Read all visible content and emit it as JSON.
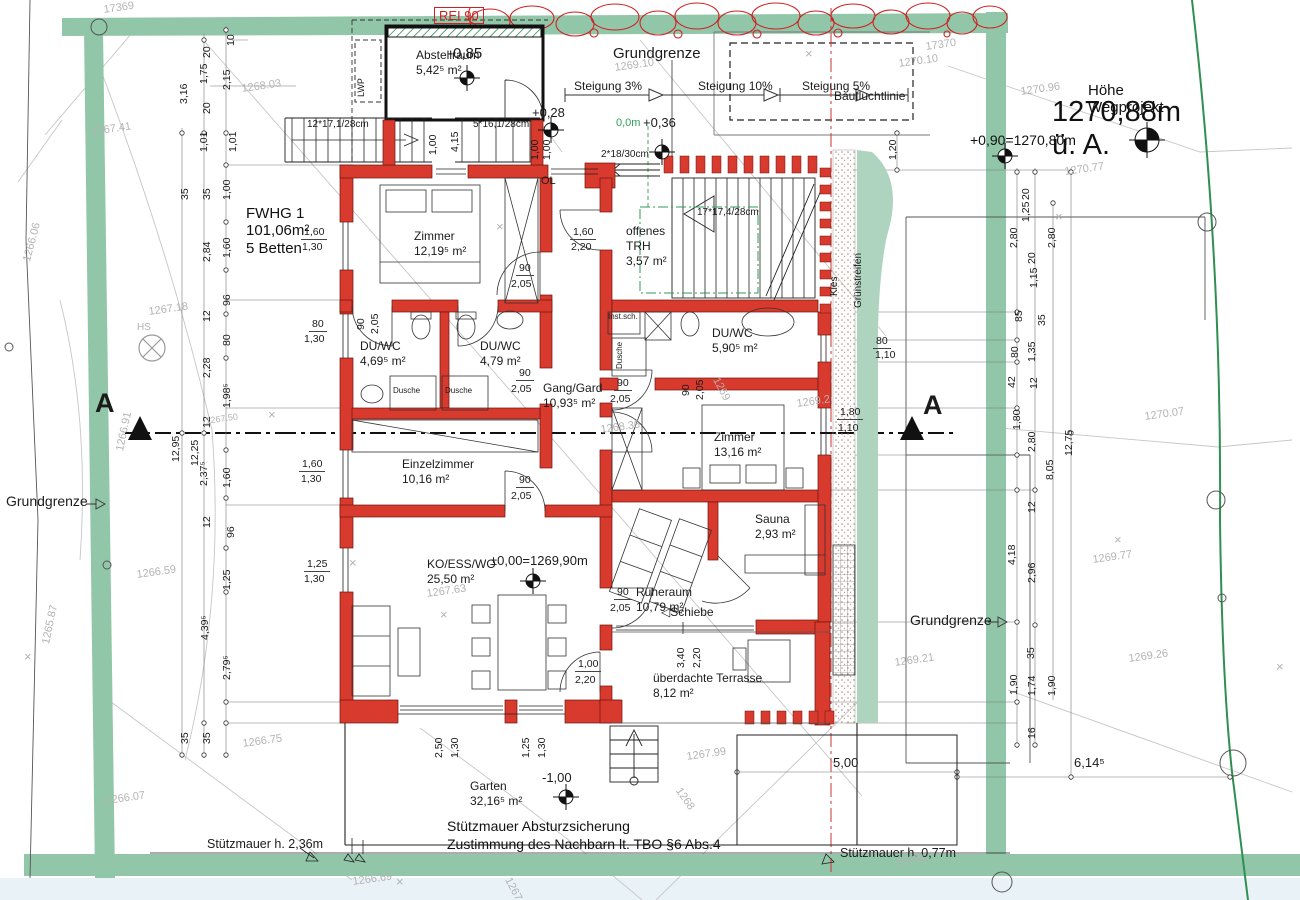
{
  "title": {
    "hoehe_label": "Höhe Wegprojekt",
    "hoehe_value": "1270,88m ü. A.",
    "weg_level": "+0,90=1270,80m"
  },
  "apartment": {
    "name": "FWHG 1",
    "area": "101,06m²",
    "beds": "5 Betten"
  },
  "notes": {
    "note1": "Stützmauer Absturzsicherung",
    "note2": "Zustimmung des Nachbarn lt. TBO §6 Abs.4"
  },
  "colors": {
    "wall_red": "#d93a2e",
    "boundary_green": "#92c6a9",
    "green_strip": "#aed3bf",
    "accent_green": "#2e9e57",
    "terrain_gray": "#b3b3b3",
    "red_line": "#cc3333"
  },
  "rooms": [
    {
      "n": "room-abstellraum",
      "name": "Abstellraum",
      "area": "5,42⁵ m²",
      "x": 416,
      "y": 48
    },
    {
      "n": "room-zimmer-1",
      "name": "Zimmer",
      "area": "12,19⁵ m²",
      "x": 414,
      "y": 229
    },
    {
      "n": "room-duwc-1",
      "name": "DU/WC",
      "area": "4,69⁵ m²",
      "x": 360,
      "y": 339
    },
    {
      "n": "room-duwc-2",
      "name": "DU/WC",
      "area": "4,79 m²",
      "x": 480,
      "y": 339
    },
    {
      "n": "room-offenes-trh",
      "name": "offenes TRH",
      "area": "3,57 m²",
      "x": 626,
      "y": 224,
      "wrap": 1
    },
    {
      "n": "room-duwc-3",
      "name": "DU/WC",
      "area": "5,90⁵ m²",
      "x": 712,
      "y": 326
    },
    {
      "n": "room-gang-gard",
      "name": "Gang/Gard",
      "area": "10,93⁵ m²",
      "x": 543,
      "y": 381
    },
    {
      "n": "room-zimmer-2",
      "name": "Zimmer",
      "area": "13,16 m²",
      "x": 714,
      "y": 430
    },
    {
      "n": "room-einzelzimmer",
      "name": "Einzelzimmer",
      "area": "10,16 m²",
      "x": 402,
      "y": 457
    },
    {
      "n": "room-sauna",
      "name": "Sauna",
      "area": "2,93 m²",
      "x": 755,
      "y": 512
    },
    {
      "n": "room-ko-ess-wo",
      "name": "KO/ESS/WO",
      "area": "25,50 m²",
      "x": 427,
      "y": 557
    },
    {
      "n": "room-ruheraum",
      "name": "Ruheraum",
      "area": "10,79 m²",
      "x": 636,
      "y": 585
    },
    {
      "n": "room-terrasse",
      "name": "überdachte Terrasse",
      "area": "8,12 m²",
      "x": 653,
      "y": 671
    },
    {
      "n": "room-garten",
      "name": "Garten",
      "area": "32,16⁵ m²",
      "x": 470,
      "y": 779
    }
  ],
  "annotations": [
    {
      "t": "Grundgrenze",
      "x": 613,
      "y": 46,
      "s": 15
    },
    {
      "t": "Steigung 3%",
      "x": 574,
      "y": 80,
      "s": 12
    },
    {
      "t": "Steigung 10%",
      "x": 698,
      "y": 80,
      "s": 12
    },
    {
      "t": "Steigung 5%",
      "x": 802,
      "y": 80,
      "s": 12
    },
    {
      "t": "Baufluchtlinie",
      "x": 834,
      "y": 90,
      "s": 12
    },
    {
      "t": "Grundgrenze",
      "x": 6,
      "y": 494,
      "s": 14
    },
    {
      "t": "Grundgrenze",
      "x": 910,
      "y": 613,
      "s": 14
    },
    {
      "t": "A",
      "x": 95,
      "y": 390,
      "s": 27,
      "c": "b"
    },
    {
      "t": "A",
      "x": 923,
      "y": 392,
      "s": 27,
      "c": "b"
    },
    {
      "t": "REI 90",
      "x": 434,
      "y": 7,
      "s": 13,
      "c": "red box"
    },
    {
      "t": "-0,85",
      "x": 448,
      "y": 46,
      "s": 15
    },
    {
      "t": "+0,28",
      "x": 532,
      "y": 106,
      "s": 13
    },
    {
      "t": "+0,36",
      "x": 643,
      "y": 116,
      "s": 13
    },
    {
      "t": "0,0m",
      "x": 616,
      "y": 118,
      "s": 11,
      "c": "grn"
    },
    {
      "t": "±0,00=1269,90m",
      "x": 490,
      "y": 554,
      "s": 13
    },
    {
      "t": "-1,00",
      "x": 542,
      "y": 771,
      "s": 13
    },
    {
      "t": "12*17,1/28cm",
      "x": 307,
      "y": 120,
      "s": 10
    },
    {
      "t": "5*16,1/28cm",
      "x": 473,
      "y": 120,
      "s": 10
    },
    {
      "t": "2*18/30cm",
      "x": 601,
      "y": 150,
      "s": 10
    },
    {
      "t": "17*17,4/28cm",
      "x": 697,
      "y": 208,
      "s": 10
    },
    {
      "t": "OL",
      "x": 541,
      "y": 176,
      "s": 11
    },
    {
      "t": "LWP",
      "x": 357,
      "y": 97,
      "s": 9,
      "r": -90
    },
    {
      "t": "HS",
      "x": 137,
      "y": 323,
      "s": 10,
      "c": "g"
    },
    {
      "t": "Inst.sch.",
      "x": 608,
      "y": 313,
      "s": 8
    },
    {
      "t": "Dusche",
      "x": 393,
      "y": 387,
      "s": 8
    },
    {
      "t": "Dusche",
      "x": 445,
      "y": 387,
      "s": 8
    },
    {
      "t": "Dusche",
      "x": 616,
      "y": 369,
      "s": 8,
      "r": -90
    },
    {
      "t": "Kies",
      "x": 830,
      "y": 296,
      "s": 10,
      "r": -90
    },
    {
      "t": "Grünstreifen",
      "x": 854,
      "y": 308,
      "s": 10,
      "r": -90
    },
    {
      "t": "◁Schiebe",
      "x": 661,
      "y": 606,
      "s": 12
    },
    {
      "t": "Stützmauer h. 2,36m",
      "x": 207,
      "y": 838,
      "s": 12.5
    },
    {
      "t": "Stützmauer h. 0,77m",
      "x": 840,
      "y": 847,
      "s": 12.5
    }
  ],
  "dimensions": [
    {
      "t": "10",
      "x": 226,
      "y": 46,
      "r": -90
    },
    {
      "t": "20",
      "x": 202,
      "y": 58,
      "r": -90
    },
    {
      "t": "1,75",
      "x": 199,
      "y": 84,
      "r": -90
    },
    {
      "t": "2,15",
      "x": 222,
      "y": 90,
      "r": -90
    },
    {
      "t": "3,16",
      "x": 179,
      "y": 104,
      "r": -90
    },
    {
      "t": "20",
      "x": 202,
      "y": 114,
      "r": -90
    },
    {
      "t": "1,01",
      "x": 199,
      "y": 152,
      "r": -90
    },
    {
      "t": "1,01",
      "x": 228,
      "y": 152,
      "r": -90
    },
    {
      "t": "35",
      "x": 180,
      "y": 200,
      "r": -90
    },
    {
      "t": "35",
      "x": 202,
      "y": 200,
      "r": -90
    },
    {
      "t": "1,00",
      "x": 222,
      "y": 200,
      "r": -90
    },
    {
      "t": "2,84",
      "x": 202,
      "y": 262,
      "r": -90
    },
    {
      "t": "1,60",
      "x": 222,
      "y": 258,
      "r": -90
    },
    {
      "t": "96",
      "x": 222,
      "y": 306,
      "r": -90
    },
    {
      "t": "12",
      "x": 202,
      "y": 322,
      "r": -90
    },
    {
      "t": "80",
      "x": 222,
      "y": 346,
      "r": -90
    },
    {
      "t": "2,28",
      "x": 202,
      "y": 378,
      "r": -90
    },
    {
      "t": "1,98⁵",
      "x": 222,
      "y": 408,
      "r": -90
    },
    {
      "t": "12",
      "x": 202,
      "y": 428,
      "r": -90
    },
    {
      "t": "12,95",
      "x": 171,
      "y": 462,
      "r": -90
    },
    {
      "t": "12,25",
      "x": 190,
      "y": 466,
      "r": -90
    },
    {
      "t": "2,37⁵",
      "x": 199,
      "y": 486,
      "r": -90
    },
    {
      "t": "1,60",
      "x": 222,
      "y": 488,
      "r": -90
    },
    {
      "t": "12",
      "x": 202,
      "y": 528,
      "r": -90
    },
    {
      "t": "96",
      "x": 226,
      "y": 538,
      "r": -90
    },
    {
      "t": "1,25",
      "x": 222,
      "y": 590,
      "r": -90
    },
    {
      "t": "4,39⁵",
      "x": 200,
      "y": 640,
      "r": -90
    },
    {
      "t": "2,79⁵",
      "x": 222,
      "y": 680,
      "r": -90
    },
    {
      "t": "35",
      "x": 180,
      "y": 744,
      "r": -90
    },
    {
      "t": "35",
      "x": 202,
      "y": 744,
      "r": -90
    },
    {
      "t": "1,00",
      "x": 428,
      "y": 155,
      "r": -90
    },
    {
      "t": "4,15",
      "x": 450,
      "y": 152,
      "r": -90
    },
    {
      "t": "1,00",
      "x": 530,
      "y": 160,
      "r": -90
    },
    {
      "t": "1,00",
      "x": 542,
      "y": 160,
      "r": -90
    },
    {
      "t": "1,20",
      "x": 888,
      "y": 160,
      "r": -90
    },
    {
      "t": "90",
      "x": 356,
      "y": 330,
      "r": -90
    },
    {
      "t": "2,05",
      "x": 370,
      "y": 334,
      "r": -90
    },
    {
      "t": "90",
      "x": 681,
      "y": 396,
      "r": -90
    },
    {
      "t": "2,05",
      "x": 695,
      "y": 400,
      "r": -90
    },
    {
      "t": "2,50",
      "x": 434,
      "y": 758,
      "r": -90
    },
    {
      "t": "1,30",
      "x": 450,
      "y": 758,
      "r": -90
    },
    {
      "t": "1,25",
      "x": 521,
      "y": 758,
      "r": -90
    },
    {
      "t": "1,30",
      "x": 537,
      "y": 758,
      "r": -90
    },
    {
      "t": "3,40",
      "x": 676,
      "y": 668,
      "r": -90
    },
    {
      "t": "2,20",
      "x": 692,
      "y": 668,
      "r": -90
    },
    {
      "t": "20",
      "x": 1021,
      "y": 200,
      "r": -90
    },
    {
      "t": "1,25",
      "x": 1021,
      "y": 222,
      "r": -90
    },
    {
      "t": "2,80",
      "x": 1009,
      "y": 248,
      "r": -90
    },
    {
      "t": "2,80",
      "x": 1047,
      "y": 248,
      "r": -90
    },
    {
      "t": "20",
      "x": 1027,
      "y": 264,
      "r": -90
    },
    {
      "t": "1,15",
      "x": 1029,
      "y": 288,
      "r": -90
    },
    {
      "t": "85",
      "x": 1014,
      "y": 322,
      "r": -90
    },
    {
      "t": "35",
      "x": 1037,
      "y": 326,
      "r": -90
    },
    {
      "t": "80",
      "x": 1010,
      "y": 358,
      "r": -90
    },
    {
      "t": "1,35",
      "x": 1027,
      "y": 362,
      "r": -90
    },
    {
      "t": "42",
      "x": 1007,
      "y": 388,
      "r": -90
    },
    {
      "t": "12",
      "x": 1029,
      "y": 389,
      "r": -90
    },
    {
      "t": "1,80",
      "x": 1012,
      "y": 430,
      "r": -90
    },
    {
      "t": "2,80",
      "x": 1027,
      "y": 452,
      "r": -90
    },
    {
      "t": "8,05",
      "x": 1045,
      "y": 480,
      "r": -90
    },
    {
      "t": "12,75",
      "x": 1064,
      "y": 456,
      "r": -90
    },
    {
      "t": "12",
      "x": 1027,
      "y": 513,
      "r": -90
    },
    {
      "t": "4,18",
      "x": 1007,
      "y": 565,
      "r": -90
    },
    {
      "t": "2,96",
      "x": 1027,
      "y": 583,
      "r": -90
    },
    {
      "t": "35",
      "x": 1026,
      "y": 659,
      "r": -90
    },
    {
      "t": "1,90",
      "x": 1009,
      "y": 695,
      "r": -90
    },
    {
      "t": "1,74",
      "x": 1027,
      "y": 696,
      "r": -90
    },
    {
      "t": "1,90",
      "x": 1047,
      "y": 696,
      "r": -90
    },
    {
      "t": "16",
      "x": 1027,
      "y": 739,
      "r": -90
    },
    {
      "t": "1,60",
      "x": 301,
      "y": 227,
      "u": 1
    },
    {
      "t": "1,30",
      "x": 302,
      "y": 242
    },
    {
      "t": "80",
      "x": 309,
      "y": 319,
      "u": 1
    },
    {
      "t": "1,30",
      "x": 304,
      "y": 334
    },
    {
      "t": "1,60",
      "x": 299,
      "y": 459,
      "u": 1
    },
    {
      "t": "1,30",
      "x": 301,
      "y": 474
    },
    {
      "t": "1,25",
      "x": 304,
      "y": 559,
      "u": 1
    },
    {
      "t": "1,30",
      "x": 304,
      "y": 574
    },
    {
      "t": "90",
      "x": 516,
      "y": 263,
      "u": 1
    },
    {
      "t": "2,05",
      "x": 511,
      "y": 279
    },
    {
      "t": "90",
      "x": 516,
      "y": 368,
      "u": 1
    },
    {
      "t": "2,05",
      "x": 511,
      "y": 384
    },
    {
      "t": "90",
      "x": 614,
      "y": 378,
      "u": 1
    },
    {
      "t": "2,05",
      "x": 610,
      "y": 394
    },
    {
      "t": "90",
      "x": 516,
      "y": 475,
      "u": 1
    },
    {
      "t": "2,05",
      "x": 511,
      "y": 491
    },
    {
      "t": "90",
      "x": 614,
      "y": 587,
      "u": 1
    },
    {
      "t": "2,05",
      "x": 610,
      "y": 603
    },
    {
      "t": "1,60",
      "x": 570,
      "y": 227,
      "u": 1
    },
    {
      "t": "2,20",
      "x": 571,
      "y": 242
    },
    {
      "t": "1,00",
      "x": 575,
      "y": 659,
      "u": 1
    },
    {
      "t": "2,20",
      "x": 575,
      "y": 675
    },
    {
      "t": "80",
      "x": 873,
      "y": 336,
      "u": 1
    },
    {
      "t": "1,10",
      "x": 875,
      "y": 350
    },
    {
      "t": "1,80",
      "x": 837,
      "y": 407,
      "u": 1
    },
    {
      "t": "1,10",
      "x": 838,
      "y": 423
    },
    {
      "t": "5,00",
      "x": 833,
      "y": 756,
      "s": 13
    },
    {
      "t": "6,14⁵",
      "x": 1074,
      "y": 756,
      "s": 13
    }
  ],
  "terrain": [
    {
      "t": "17369",
      "x": 103,
      "y": 5
    },
    {
      "t": "1268.03",
      "x": 241,
      "y": 84
    },
    {
      "t": "1267.41",
      "x": 91,
      "y": 127
    },
    {
      "t": "1266.06",
      "x": 22,
      "y": 260,
      "r": -75
    },
    {
      "t": "1269.10",
      "x": 614,
      "y": 63
    },
    {
      "t": "1270.10",
      "x": 898,
      "y": 59
    },
    {
      "t": "17370",
      "x": 925,
      "y": 42
    },
    {
      "t": "1270.96",
      "x": 1020,
      "y": 87
    },
    {
      "t": "1270.77",
      "x": 1064,
      "y": 167
    },
    {
      "t": "1270.07",
      "x": 1144,
      "y": 412
    },
    {
      "t": "1267.18",
      "x": 148,
      "y": 307
    },
    {
      "t": "1267.50",
      "x": 205,
      "y": 417,
      "s": 9
    },
    {
      "t": "1266.91",
      "x": 115,
      "y": 450,
      "r": -78
    },
    {
      "t": "1265.87",
      "x": 41,
      "y": 643,
      "r": -78
    },
    {
      "t": "1266.59",
      "x": 136,
      "y": 570
    },
    {
      "t": "1266.75",
      "x": 242,
      "y": 739
    },
    {
      "t": "1266.07",
      "x": 105,
      "y": 796
    },
    {
      "t": "1266.69",
      "x": 352,
      "y": 877
    },
    {
      "t": "1267.63",
      "x": 426,
      "y": 589
    },
    {
      "t": "1268.36",
      "x": 600,
      "y": 425
    },
    {
      "t": "1269.2",
      "x": 796,
      "y": 399
    },
    {
      "t": "1269.21",
      "x": 894,
      "y": 658
    },
    {
      "t": "1267.99",
      "x": 686,
      "y": 752
    },
    {
      "t": "1269.26",
      "x": 1128,
      "y": 654
    },
    {
      "t": "1269.77",
      "x": 1092,
      "y": 555
    },
    {
      "t": "15795",
      "x": 896,
      "y": 858
    },
    {
      "t": "1268",
      "x": 682,
      "y": 786,
      "r": 55
    },
    {
      "t": "1267",
      "x": 512,
      "y": 876,
      "r": 62
    },
    {
      "t": "1269",
      "x": 720,
      "y": 376,
      "r": 62
    },
    {
      "t": "×",
      "x": 496,
      "y": 220,
      "r": 0,
      "s": 13
    },
    {
      "t": "×",
      "x": 805,
      "y": 47,
      "r": 0,
      "s": 13
    },
    {
      "t": "×",
      "x": 1055,
      "y": 210,
      "r": 0,
      "s": 13
    },
    {
      "t": "×",
      "x": 349,
      "y": 556,
      "r": 0,
      "s": 13
    },
    {
      "t": "×",
      "x": 440,
      "y": 608,
      "r": 0,
      "s": 13
    },
    {
      "t": "×",
      "x": 1114,
      "y": 533,
      "r": 0,
      "s": 13
    },
    {
      "t": "×",
      "x": 1276,
      "y": 660,
      "r": 0,
      "s": 13
    },
    {
      "t": "×",
      "x": 268,
      "y": 408,
      "r": 0,
      "s": 13
    },
    {
      "t": "×",
      "x": 396,
      "y": 875,
      "r": 0,
      "s": 13
    },
    {
      "t": "×",
      "x": 24,
      "y": 650,
      "r": 0,
      "s": 13
    }
  ]
}
